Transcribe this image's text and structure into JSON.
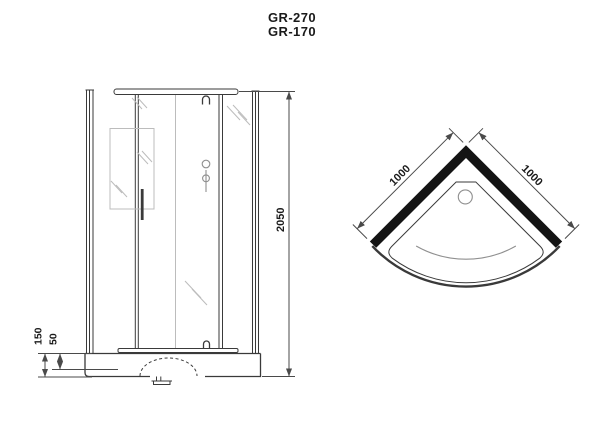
{
  "title": {
    "model_1": "GR-270",
    "model_2": "GR-170"
  },
  "front_view": {
    "overall_height_mm": "2050",
    "tray_height_mm": "150",
    "tray_step_mm": "50"
  },
  "top_view": {
    "left_side_mm": "1000",
    "right_side_mm": "1000"
  },
  "colors": {
    "background": "#ffffff",
    "line": "#3a3a3a",
    "dim_line": "#4a4a4a",
    "text": "#1a1a1a",
    "light_line": "#8f8f8f",
    "faint_line": "#bcbcbc",
    "wall_fill": "#141414"
  }
}
